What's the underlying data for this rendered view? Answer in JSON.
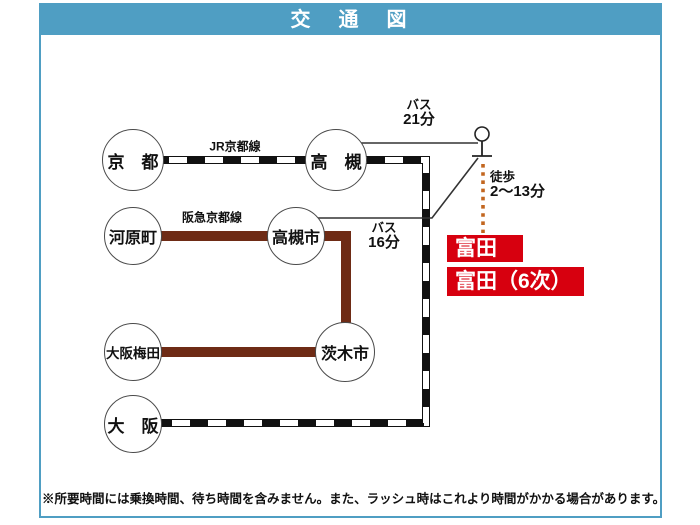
{
  "header": {
    "title": "交　通　図"
  },
  "stations": {
    "kyoto": "京　都",
    "takatsuki": "高　槻",
    "kawaramachi": "河原町",
    "takatsukishi": "高槻市",
    "osakaumeda": "大阪梅田",
    "ibarakishi": "茨木市",
    "osaka": "大　阪"
  },
  "rail_lines": {
    "jr_kyoto_line": "JR京都線",
    "hankyu_kyoto_line": "阪急京都線"
  },
  "segments": {
    "bus21": {
      "mode": "バス",
      "time": "21分"
    },
    "bus16": {
      "mode": "バス",
      "time": "16分"
    },
    "walk": {
      "mode": "徒歩",
      "time": "2〜13分"
    }
  },
  "destinations": {
    "tonda": "富田",
    "tonda_6": "富田（6次）"
  },
  "note": "※所要時間には乗換時間、待ち時間を含みません。また、ラッシュ時はこれより時間がかかる場合があります。",
  "colors": {
    "header_blue": "#4f9ec3",
    "badge_red": "#d7000f",
    "hankyu_brown": "#6e2b15",
    "walk_orange": "#c2661f",
    "jr_black": "#111111"
  }
}
